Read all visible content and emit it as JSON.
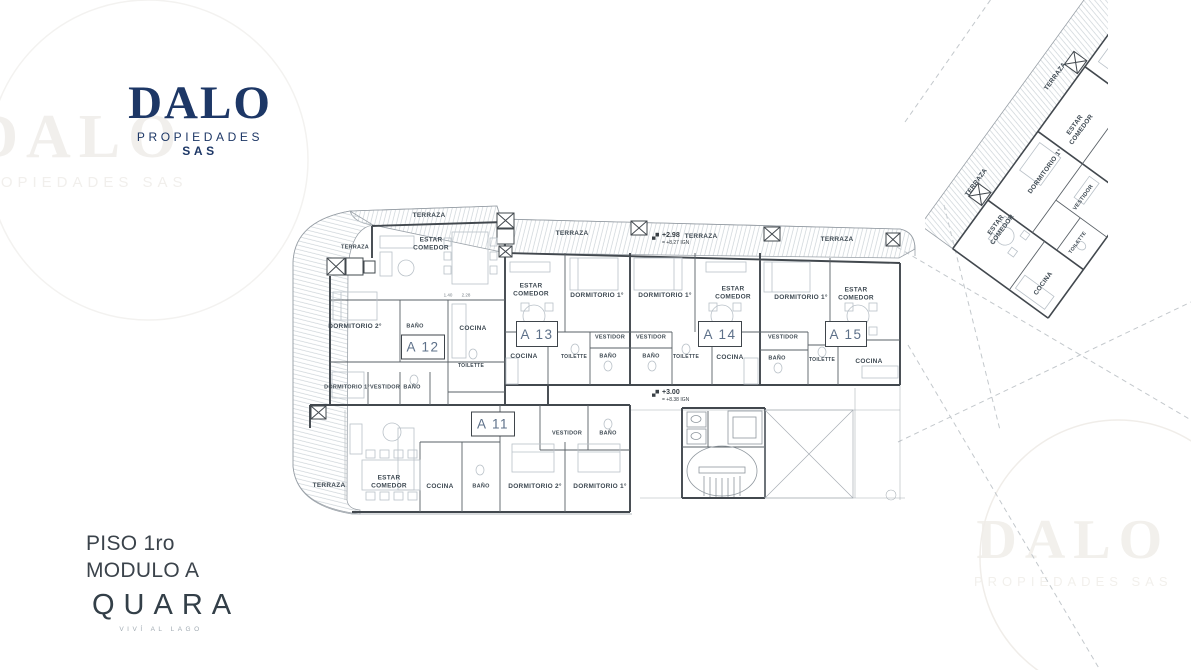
{
  "logo": {
    "name": "DALO",
    "subtitle": "PROPIEDADES",
    "suffix": "SAS"
  },
  "watermark": {
    "name": "DALO",
    "subtitle": "PROPIEDADES SAS"
  },
  "floor_info": {
    "line1": "PISO 1ro",
    "line2": "MODULO A"
  },
  "brand": {
    "name": "QUARA",
    "tagline": "VIVÍ AL LAGO"
  },
  "colors": {
    "logo_navy": "#1d3766",
    "unit_text": "#5d7089",
    "label_dark": "#3e4952",
    "wall_dark": "#42484e",
    "hatch": "#ccd3d8",
    "watermark": "#f1efec"
  },
  "units": [
    {
      "id": "A 11",
      "x": 493,
      "y": 424,
      "w": 42,
      "h": 23
    },
    {
      "id": "A 12",
      "x": 423,
      "y": 347,
      "w": 42,
      "h": 23
    },
    {
      "id": "A 13",
      "x": 537,
      "y": 334,
      "w": 40,
      "h": 24
    },
    {
      "id": "A 14",
      "x": 720,
      "y": 334,
      "w": 42,
      "h": 24
    },
    {
      "id": "A 15",
      "x": 846,
      "y": 334,
      "w": 40,
      "h": 24
    }
  ],
  "markers": [
    {
      "value": "+2.98",
      "ref": "= +8.27 IGN",
      "x": 652,
      "y": 239
    },
    {
      "value": "+3.00",
      "ref": "= +8.38 IGN",
      "x": 652,
      "y": 396
    }
  ],
  "rooms": [
    {
      "t": "TERRAZA",
      "x": 429,
      "y": 216
    },
    {
      "t": "TERRAZA",
      "x": 355,
      "y": 248,
      "s": 5.5
    },
    {
      "t": "ESTAR\nCOMEDOR",
      "x": 431,
      "y": 245
    },
    {
      "t": "TERRAZA",
      "x": 572,
      "y": 234
    },
    {
      "t": "TERRAZA",
      "x": 701,
      "y": 237
    },
    {
      "t": "TERRAZA",
      "x": 837,
      "y": 240
    },
    {
      "t": "ESTAR\nCOMEDOR",
      "x": 531,
      "y": 291
    },
    {
      "t": "DORMITORIO 1°",
      "x": 597,
      "y": 296
    },
    {
      "t": "DORMITORIO 1°",
      "x": 665,
      "y": 296
    },
    {
      "t": "ESTAR\nCOMEDOR",
      "x": 733,
      "y": 294
    },
    {
      "t": "DORMITORIO 1°",
      "x": 801,
      "y": 298
    },
    {
      "t": "ESTAR\nCOMEDOR",
      "x": 856,
      "y": 295
    },
    {
      "t": "DORMITORIO 2°",
      "x": 355,
      "y": 327
    },
    {
      "t": "BAÑO",
      "x": 415,
      "y": 327,
      "s": 5.5
    },
    {
      "t": "COCINA",
      "x": 473,
      "y": 329
    },
    {
      "t": "TOILETTE",
      "x": 471,
      "y": 366,
      "s": 5
    },
    {
      "t": "COCINA",
      "x": 524,
      "y": 357
    },
    {
      "t": "TOILETTE",
      "x": 574,
      "y": 357,
      "s": 5
    },
    {
      "t": "VESTIDOR",
      "x": 610,
      "y": 338,
      "s": 5.5
    },
    {
      "t": "BAÑO",
      "x": 608,
      "y": 357,
      "s": 5.5
    },
    {
      "t": "VESTIDOR",
      "x": 651,
      "y": 338,
      "s": 5.5
    },
    {
      "t": "BAÑO",
      "x": 651,
      "y": 357,
      "s": 5.5
    },
    {
      "t": "TOILETTE",
      "x": 686,
      "y": 357,
      "s": 5
    },
    {
      "t": "COCINA",
      "x": 730,
      "y": 358
    },
    {
      "t": "VESTIDOR",
      "x": 783,
      "y": 338,
      "s": 5.5
    },
    {
      "t": "BAÑO",
      "x": 777,
      "y": 359,
      "s": 5.5
    },
    {
      "t": "TOILETTE",
      "x": 822,
      "y": 360,
      "s": 5
    },
    {
      "t": "COCINA",
      "x": 869,
      "y": 362
    },
    {
      "t": "DORMITORIO 1°",
      "x": 347,
      "y": 388,
      "s": 5.5
    },
    {
      "t": "VESTIDOR",
      "x": 385,
      "y": 388,
      "s": 5.5
    },
    {
      "t": "BAÑO",
      "x": 412,
      "y": 388,
      "s": 5.5
    },
    {
      "t": "TERRAZA",
      "x": 329,
      "y": 486
    },
    {
      "t": "ESTAR\nCOMEDOR",
      "x": 389,
      "y": 483
    },
    {
      "t": "COCINA",
      "x": 440,
      "y": 487
    },
    {
      "t": "BAÑO",
      "x": 481,
      "y": 487,
      "s": 5.5
    },
    {
      "t": "DORMITORIO 2°",
      "x": 535,
      "y": 487
    },
    {
      "t": "DORMITORIO 1°",
      "x": 600,
      "y": 487
    },
    {
      "t": "VESTIDOR",
      "x": 567,
      "y": 434,
      "s": 5.5
    },
    {
      "t": "BAÑO",
      "x": 608,
      "y": 434,
      "s": 5.5
    },
    {
      "t": "TERRAZA",
      "x": 1056,
      "y": 77,
      "r": -54
    },
    {
      "t": "ESTAR\nCOMEDOR",
      "x": 1079,
      "y": 128,
      "r": -54
    },
    {
      "t": "DORMITORIO 1°",
      "x": 1046,
      "y": 172,
      "r": -54
    },
    {
      "t": "TERRAZA",
      "x": 977,
      "y": 183,
      "r": -54
    },
    {
      "t": "ESTAR\nCOMEDOR",
      "x": 1000,
      "y": 228,
      "r": -54
    },
    {
      "t": "VESTIDOR",
      "x": 1084,
      "y": 198,
      "r": -54,
      "s": 5.5
    },
    {
      "t": "TOILETTE",
      "x": 1078,
      "y": 243,
      "r": -54,
      "s": 5
    },
    {
      "t": "COCINA",
      "x": 1044,
      "y": 284,
      "r": -54
    }
  ],
  "dims": [
    {
      "t": "1.40",
      "x": 448,
      "y": 295
    },
    {
      "t": "2.28",
      "x": 466,
      "y": 295
    }
  ]
}
